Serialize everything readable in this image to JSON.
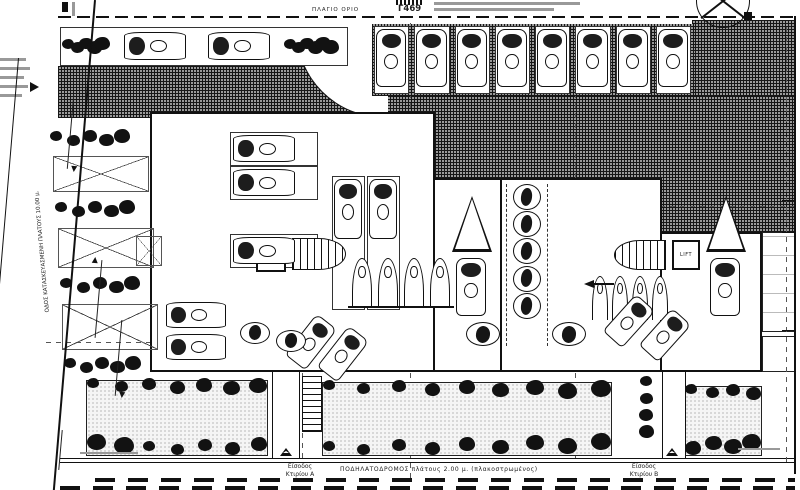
{
  "page": {
    "paper_color": "#ffffff",
    "ink_color": "#1a1a1a",
    "paving_color": "#9a9a9a"
  },
  "annotations": {
    "side_boundary_label": "ΠΛΑΓΙΟ ΟΡΙΟ",
    "block_label": "Γ469",
    "road_label": "ΟΔΟΣ ΚΑΤΑΣΚΕΥΑΣΜΕΝΗ ΠΛΑΤΟΥΣ 10.00 μ.",
    "bike_path_label": "ΠΟΔΗΛΑΤΟΔΡΟΜΟΣ  πλάτους 2.00 μ.  (πλακοστρωμένος)",
    "entrance_a": {
      "line1": "Είσοδος",
      "line2": "Κτιρίου Α"
    },
    "entrance_b": {
      "line1": "Είσοδος",
      "line2": "Κτιρίου Β"
    },
    "core_a_lift_label": "LIFT",
    "core_b_lift_label": "LIFT"
  }
}
